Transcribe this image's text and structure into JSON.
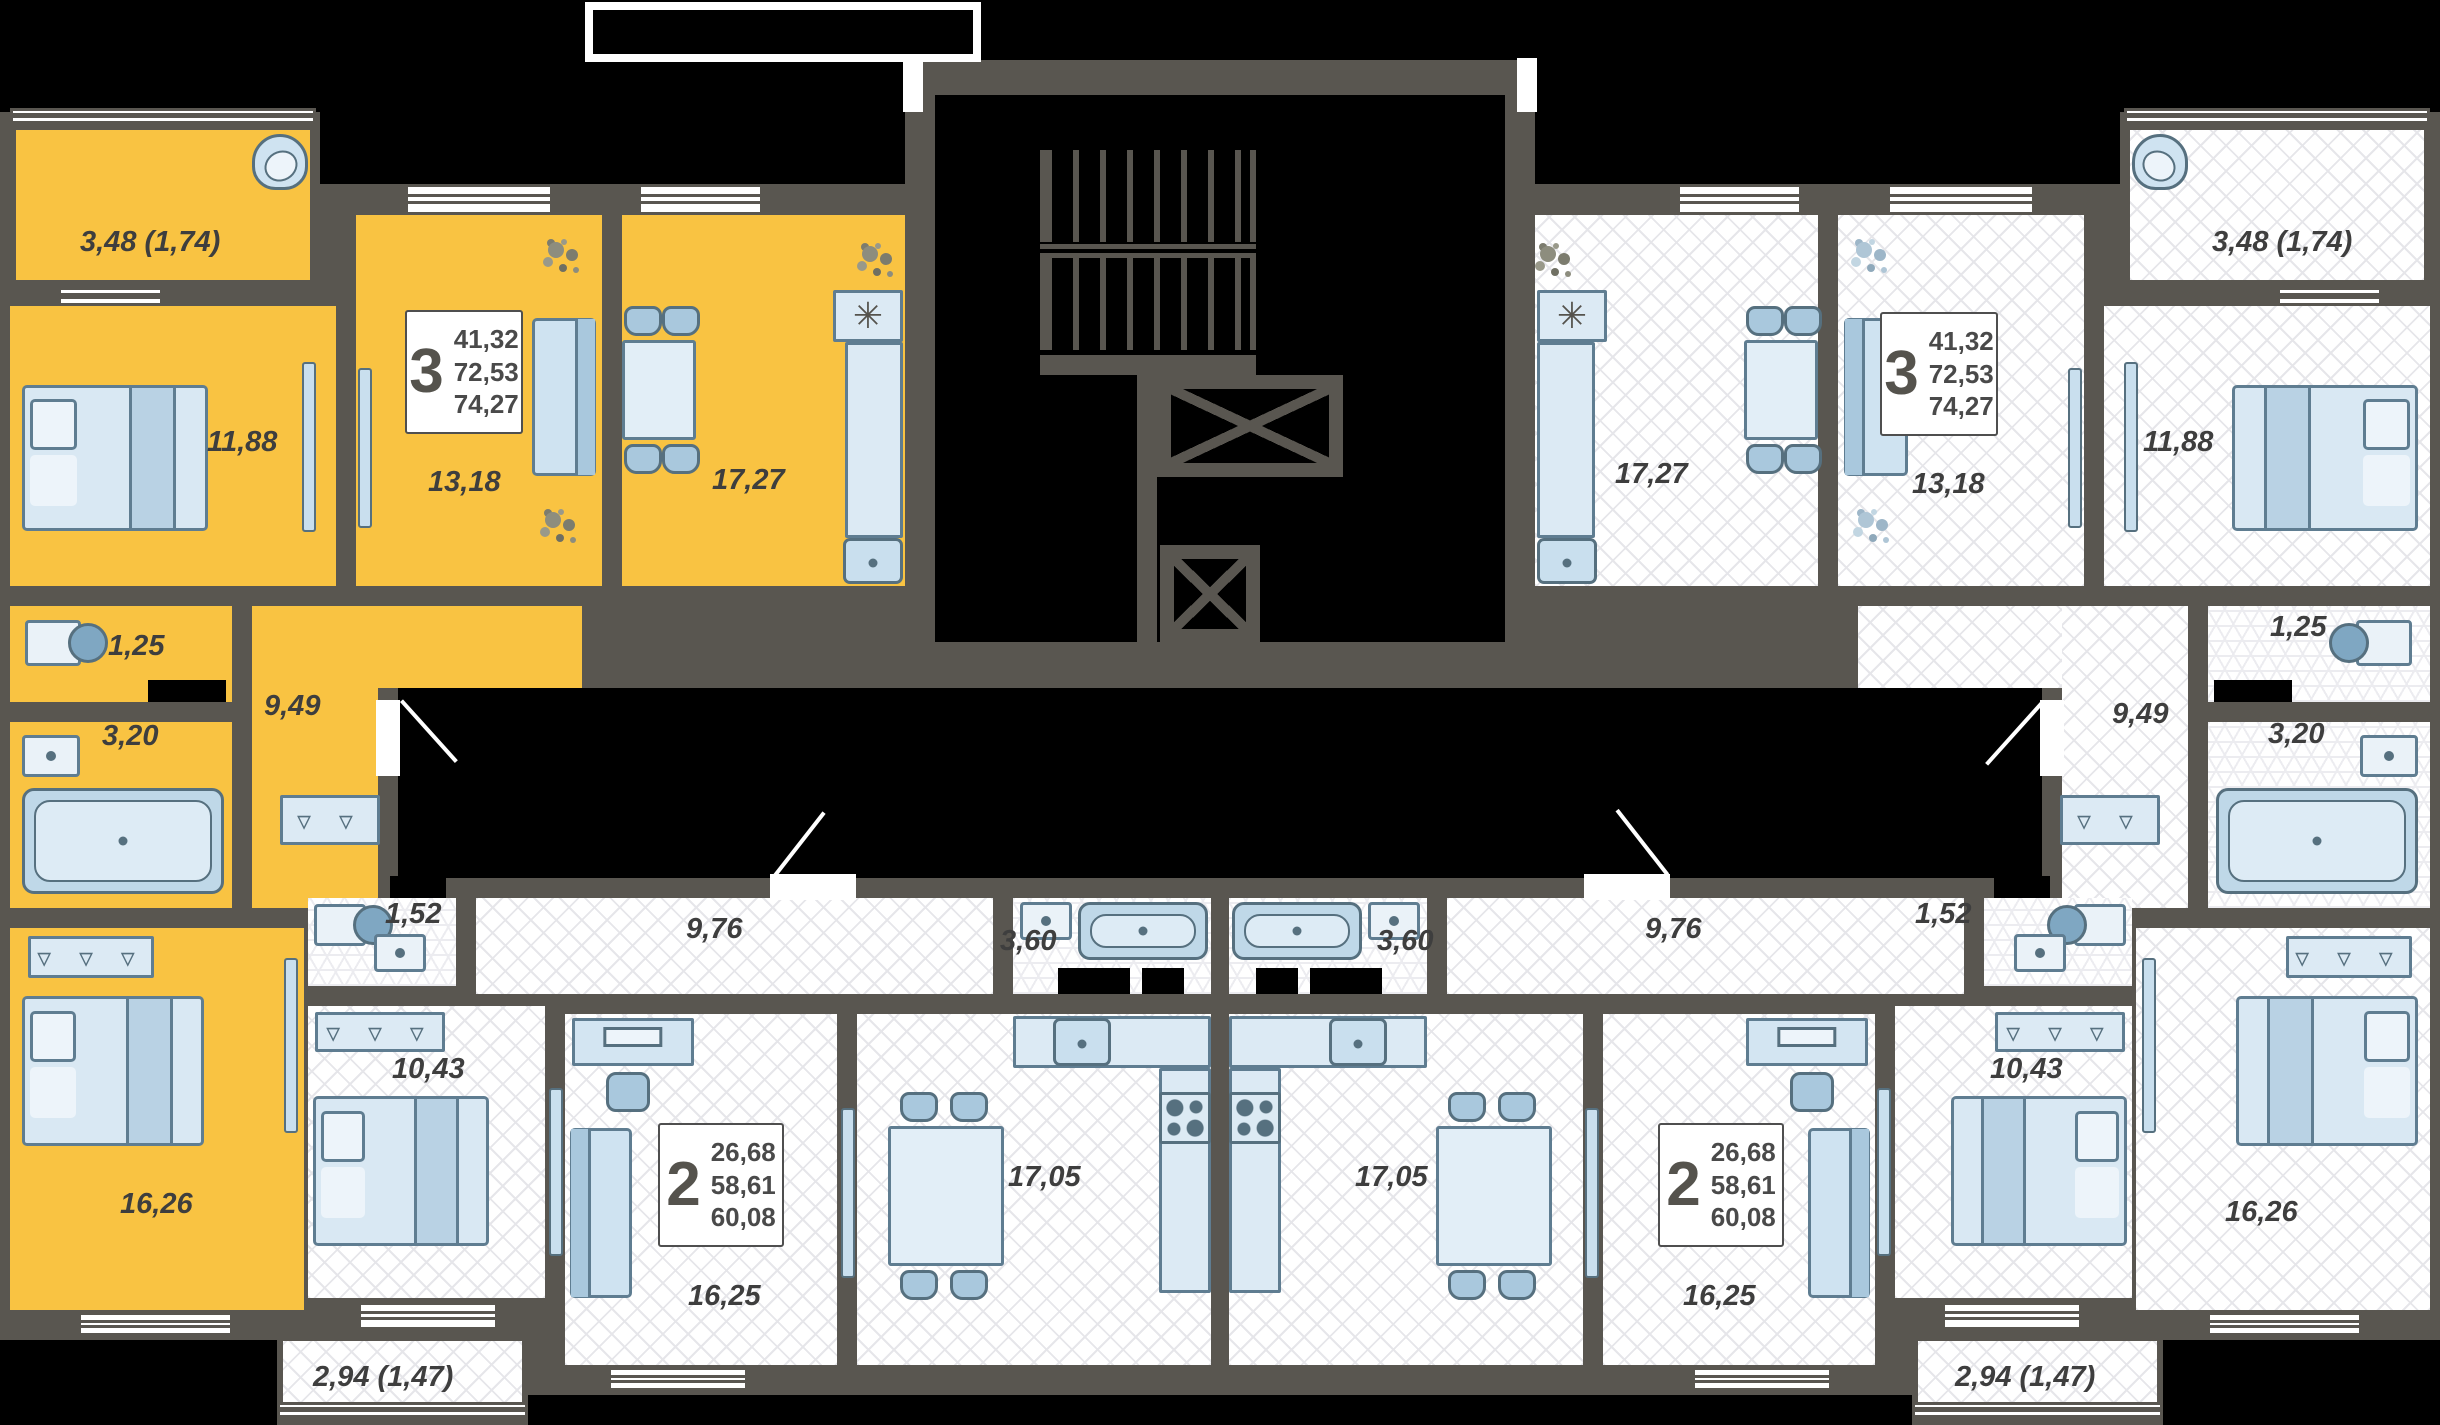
{
  "colors": {
    "background": "#000000",
    "wall": "#595650",
    "highlight_apartment": "#F9C342",
    "floor": "#FFFFFF",
    "furniture": "#D9E8F3"
  },
  "symbols": {
    "stove": "✳",
    "hanger3": "▿ ▿ ▿",
    "hanger2": "▿ ▿"
  },
  "apartments": {
    "tl3": {
      "info": {
        "rooms": "3",
        "area_living": "41,32",
        "area_usable": "72,53",
        "area_total": "74,27"
      },
      "rooms": {
        "balcony": "3,48 (1,74)",
        "bedroom": "11,88",
        "living": "13,18",
        "kitchen": "17,27",
        "wc": "1,25",
        "bathroom": "3,20",
        "hallway": "9,49",
        "bedroom2": "16,26"
      }
    },
    "tr3": {
      "info": {
        "rooms": "3",
        "area_living": "41,32",
        "area_usable": "72,53",
        "area_total": "74,27"
      },
      "rooms": {
        "balcony": "3,48 (1,74)",
        "bedroom": "11,88",
        "living": "13,18",
        "kitchen": "17,27",
        "wc": "1,25",
        "bathroom": "3,20",
        "hallway": "9,49",
        "bedroom2": "16,26"
      }
    },
    "bl2": {
      "info": {
        "rooms": "2",
        "area_living": "26,68",
        "area_usable": "58,61",
        "area_total": "60,08"
      },
      "rooms": {
        "wc": "1,52",
        "hallway": "9,76",
        "bathroom": "3,60",
        "bedroom": "10,43",
        "living": "16,25",
        "kitchen": "17,05",
        "balcony": "2,94 (1,47)"
      }
    },
    "br2": {
      "info": {
        "rooms": "2",
        "area_living": "26,68",
        "area_usable": "58,61",
        "area_total": "60,08"
      },
      "rooms": {
        "wc": "1,52",
        "hallway": "9,76",
        "bathroom": "3,60",
        "bedroom": "10,43",
        "living": "16,25",
        "kitchen": "17,05",
        "balcony": "2,94 (1,47)"
      }
    }
  }
}
